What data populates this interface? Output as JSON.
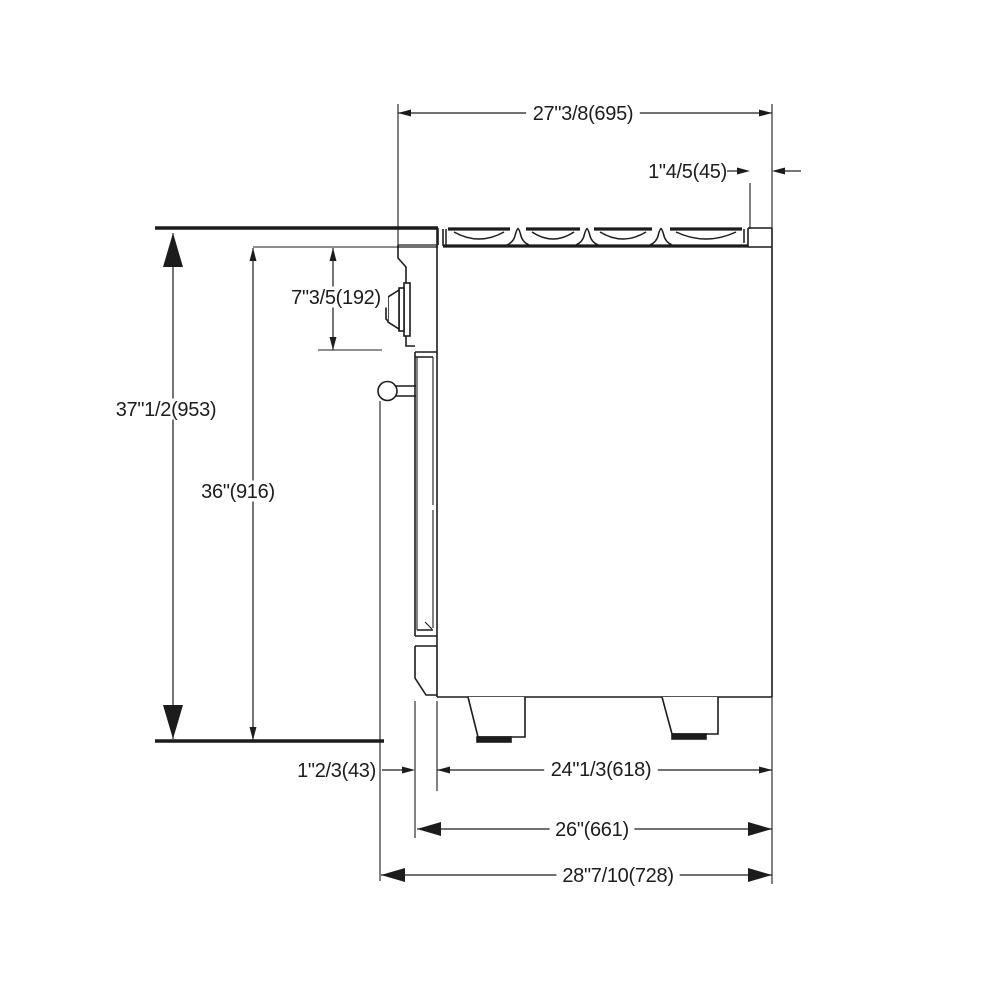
{
  "drawing": {
    "description": "Side-view dimension drawing of a freestanding gas range",
    "colors": {
      "line": "#1c1c1c",
      "background": "#ffffff"
    }
  },
  "dimensions": [
    {
      "id": "cooktop-depth",
      "label": "27\"3/8(695)",
      "value_mm": 695,
      "type": "h",
      "x1": 398,
      "x2": 772,
      "y": 113,
      "arrow": "small",
      "label_x": 583,
      "label_y": 113,
      "anchor": "middle"
    },
    {
      "id": "rear-ledge-depth",
      "label": "1\"4/5(45)",
      "value_mm": 45,
      "type": "hout",
      "x1": 750,
      "x2": 772,
      "y": 171,
      "arrow": "small",
      "label_x": 727,
      "label_y": 171,
      "anchor": "end",
      "sides": "both",
      "tail": 16
    },
    {
      "id": "control-panel-height",
      "label": "7\"3/5(192)",
      "value_mm": 192,
      "type": "v",
      "x": 333,
      "y1": 248,
      "y2": 350,
      "arrow": "small",
      "label_x": 336,
      "label_y": 297,
      "anchor": "middle"
    },
    {
      "id": "countertop-height",
      "label": "37\"1/2(953)",
      "value_mm": 953,
      "type": "v",
      "x": 173,
      "y1": 233,
      "y2": 739,
      "arrow": "xlarge",
      "label_x": 166,
      "label_y": 409,
      "anchor": "middle"
    },
    {
      "id": "cooktop-height",
      "label": "36\"(916)",
      "value_mm": 916,
      "type": "v",
      "x": 253,
      "y1": 248,
      "y2": 740,
      "arrow": "small",
      "label_x": 238,
      "label_y": 491,
      "anchor": "middle"
    },
    {
      "id": "door-offset",
      "label": "1\"2/3(43)",
      "value_mm": 43,
      "type": "hout",
      "x1": 415,
      "x2": 437,
      "y": 770,
      "arrow": "small",
      "label_x": 376,
      "label_y": 770,
      "anchor": "end",
      "sides": "left",
      "tail": 20
    },
    {
      "id": "body-depth",
      "label": "24\"1/3(618)",
      "value_mm": 618,
      "type": "h",
      "x1": 437,
      "x2": 772,
      "y": 770,
      "arrow": "small",
      "label_x": 601,
      "label_y": 769,
      "anchor": "middle"
    },
    {
      "id": "door-depth",
      "label": "26\"(661)",
      "value_mm": 661,
      "type": "h",
      "x1": 417,
      "x2": 772,
      "y": 829,
      "arrow": "large",
      "label_x": 592,
      "label_y": 829,
      "anchor": "middle"
    },
    {
      "id": "total-depth",
      "label": "28\"7/10(728)",
      "value_mm": 728,
      "type": "h",
      "x1": 381,
      "x2": 772,
      "y": 875,
      "arrow": "large",
      "label_x": 618,
      "label_y": 875,
      "anchor": "middle"
    }
  ]
}
